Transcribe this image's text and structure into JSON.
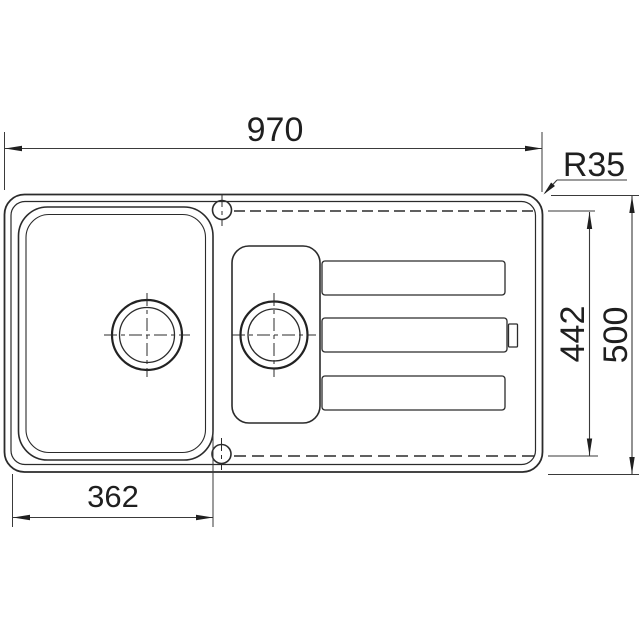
{
  "drawing": {
    "kind": "plan-view technical drawing of a kitchen sink with one and a half bowls and a drainboard",
    "dimensions": {
      "overall_width_mm": "970",
      "corner_radius": "R35",
      "cutout_depth_mm": "442",
      "overall_depth_mm": "500",
      "bowl_width_mm": "362"
    },
    "colors": {
      "line": "#2b2b2b",
      "dimension_text": "#1f1f1f",
      "background": "#ffffff"
    }
  }
}
